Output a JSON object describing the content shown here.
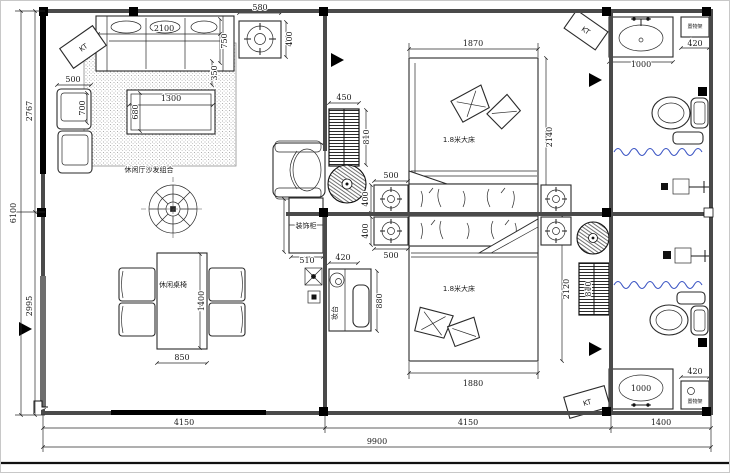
{
  "labels": {
    "kt": "KT",
    "living_sofa_group": "休闲厅沙发组合",
    "leisure_table": "休闲桌椅",
    "double_bed": "1.8米大床",
    "vanity": "妆台",
    "deco_cabinet": "装饰柜",
    "shelf": "置物架"
  },
  "dims": {
    "left_total": "6100",
    "left_upper": "2767",
    "left_lower": "2995",
    "bottom_seg1": "4150",
    "bottom_seg2": "4150",
    "bottom_seg3": "1400",
    "bottom_total": "9900",
    "sofa_width": "2100",
    "sofa_depth": "750",
    "sofa_side": "350",
    "side_table_width": "580",
    "side_table_depth": "400",
    "single_sofa_width": "500",
    "single_sofa_depth": "700",
    "coffee_table_width": "1300",
    "coffee_table_depth": "680",
    "radiator_width": "450",
    "radiator_height": "810",
    "radiator2_height": "810",
    "bed1_width": "1870",
    "bed1_length": "2140",
    "bed2_width": "1880",
    "bed2_length": "2120",
    "nightstand_width": "500",
    "nightstand_depth": "400",
    "cabinet_width": "510",
    "vanity_width": "420",
    "vanity_length": "880",
    "dining_width": "850",
    "dining_length": "1400",
    "basin_width": "1000",
    "shelf_width": "420"
  }
}
